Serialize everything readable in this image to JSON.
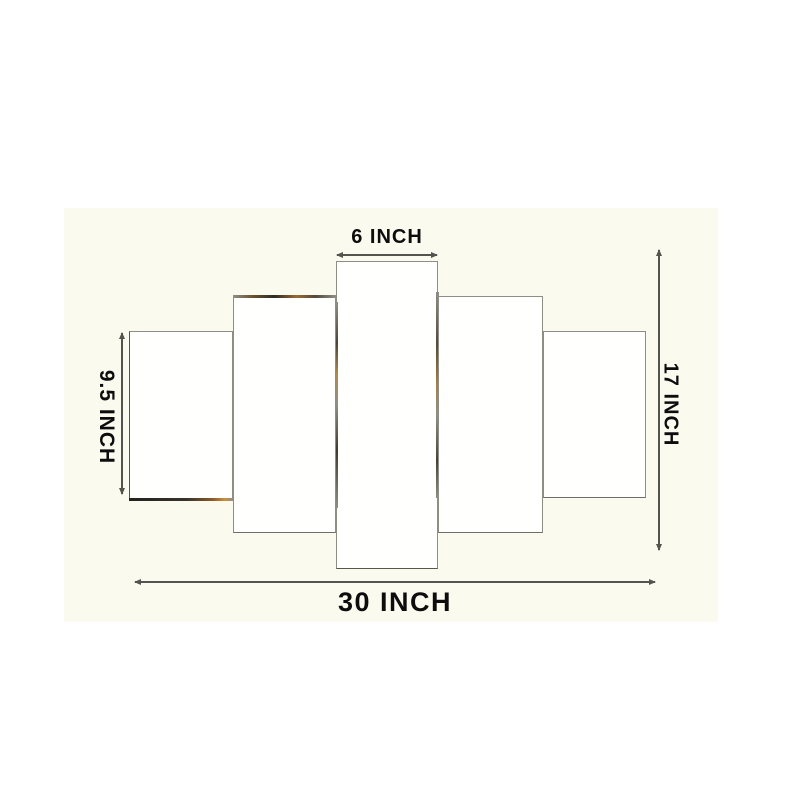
{
  "diagram": {
    "title": "5-panel wall art set size diagram",
    "panel_count": 5,
    "labels": {
      "top": "6 INCH",
      "left": "9.5 INCH",
      "right": "17 INCH",
      "bottom": "30 INCH"
    },
    "dimensions_inch": {
      "center_panel_width": 6,
      "outer_panel_height": 9.5,
      "total_height": 17,
      "total_width": 30
    },
    "colors": {
      "page_bg": "#ffffff",
      "photo_bg": "#fbfaef",
      "panel_fill": "#fffffd",
      "panel_border": "#8f8e86",
      "line": "#55534d",
      "text": "#0d0d0d",
      "accent_gold": "#9a6a33"
    }
  }
}
